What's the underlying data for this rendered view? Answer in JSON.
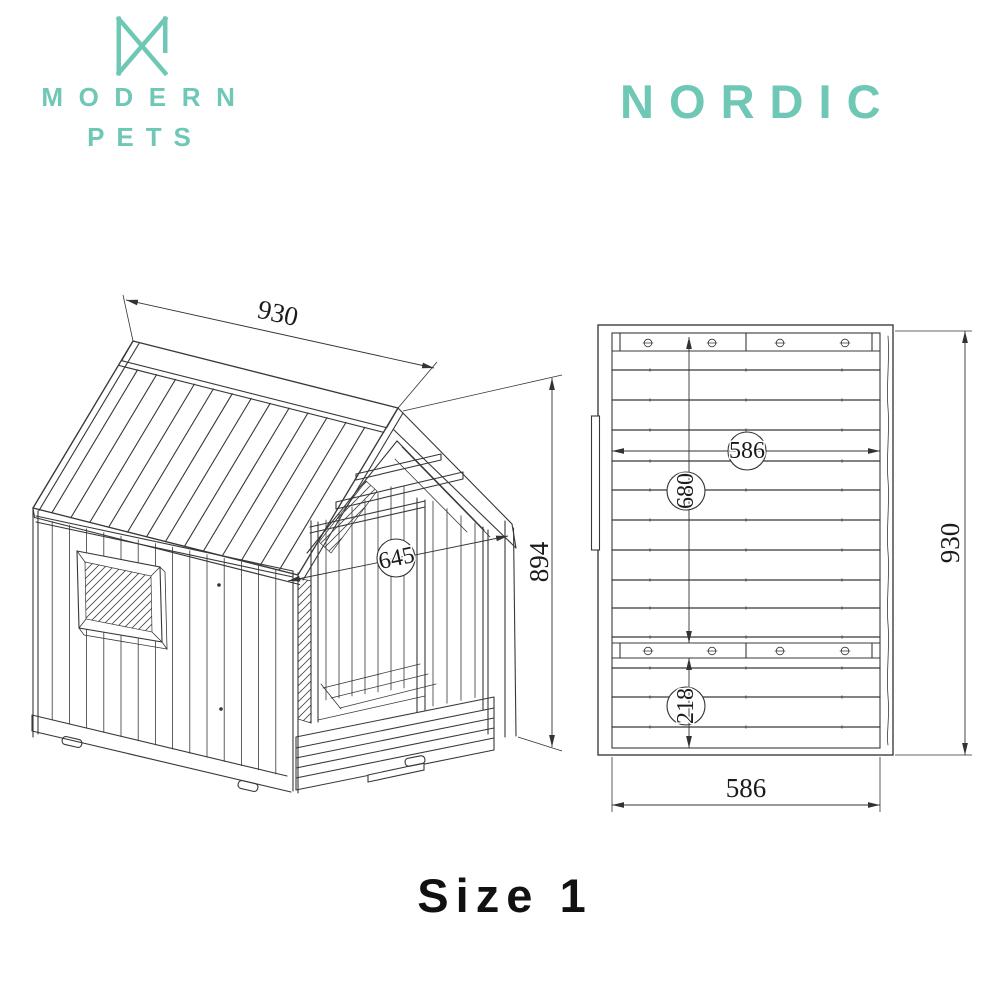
{
  "brand": {
    "name_line1": "MODERN",
    "name_line2": "PETS",
    "accent_color": "#6fc7b5"
  },
  "product": {
    "name": "NORDIC"
  },
  "size_label": "Size 1",
  "iso_view": {
    "dim_roof_length": "930",
    "dim_height": "894",
    "dim_opening_width": "645"
  },
  "top_view": {
    "dim_inner_width": "586",
    "dim_upper_length": "680",
    "dim_lower_length": "218",
    "dim_outer_length": "930",
    "dim_bottom_width": "586"
  }
}
